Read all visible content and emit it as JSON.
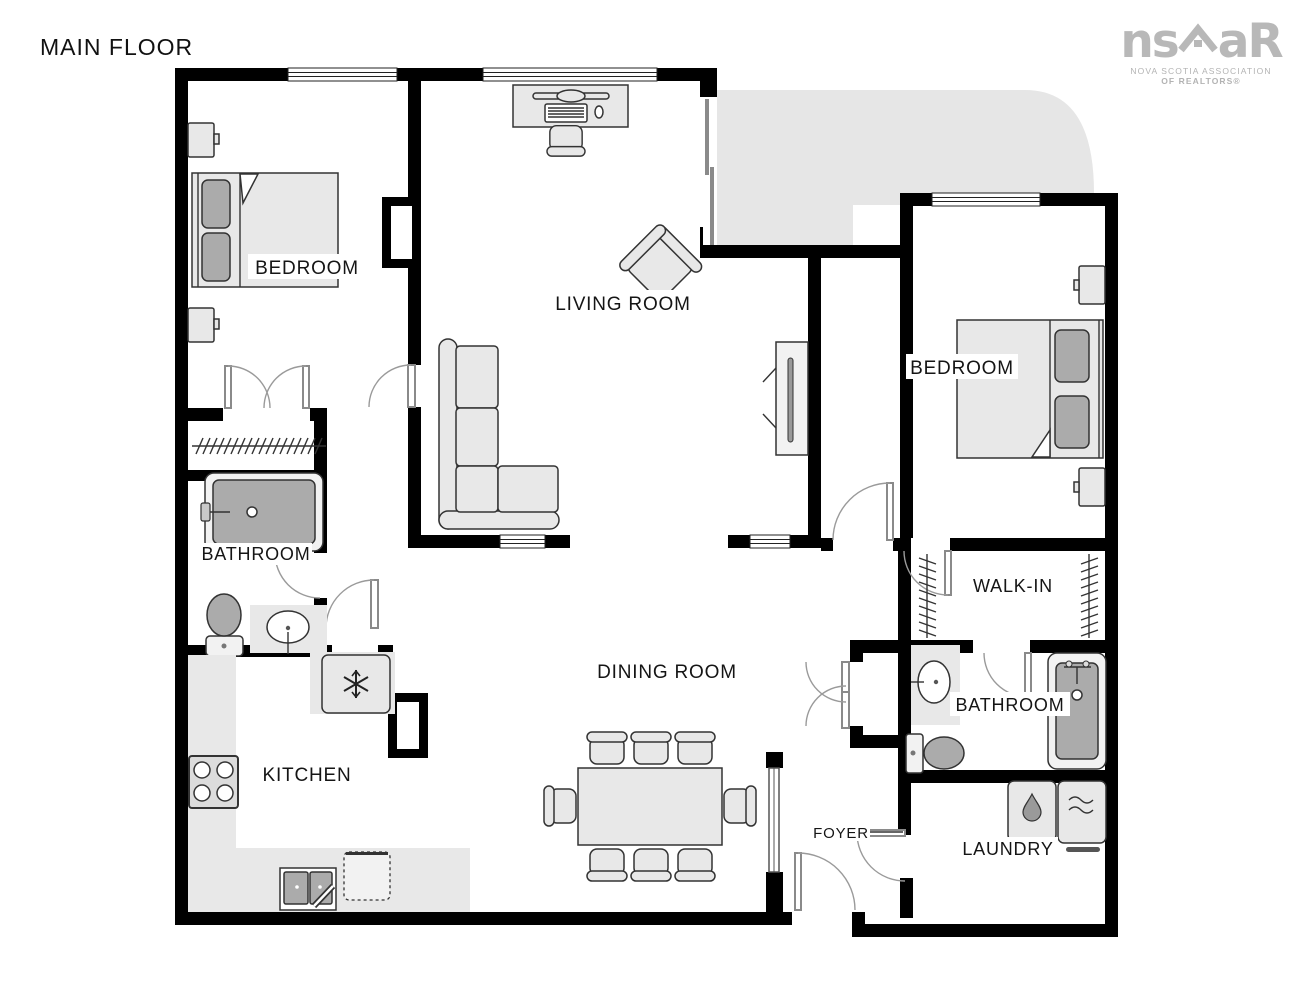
{
  "page": {
    "title": "MAIN FLOOR"
  },
  "logo": {
    "prefix": "ns",
    "suffix": "aR",
    "tagline1": "NOVA SCOTIA ASSOCIATION",
    "tagline2": "OF REALTORS®"
  },
  "rooms": {
    "bedroom_left": "BEDROOM",
    "living_room": "LIVING ROOM",
    "bedroom_right": "BEDROOM",
    "bathroom_left": "BATHROOM",
    "kitchen": "KITCHEN",
    "dining_room": "DINING ROOM",
    "walk_in": "WALK-IN",
    "bathroom_right": "BATHROOM",
    "foyer": "FOYER",
    "laundry": "LAUNDRY"
  },
  "colors": {
    "wall": "#000000",
    "furniture_fill": "#e8e8e8",
    "accent_gray": "#ababab",
    "balcony_gray": "#e6e6e6",
    "label_text": "#151515",
    "logo_gray": "#b8b8b8"
  }
}
